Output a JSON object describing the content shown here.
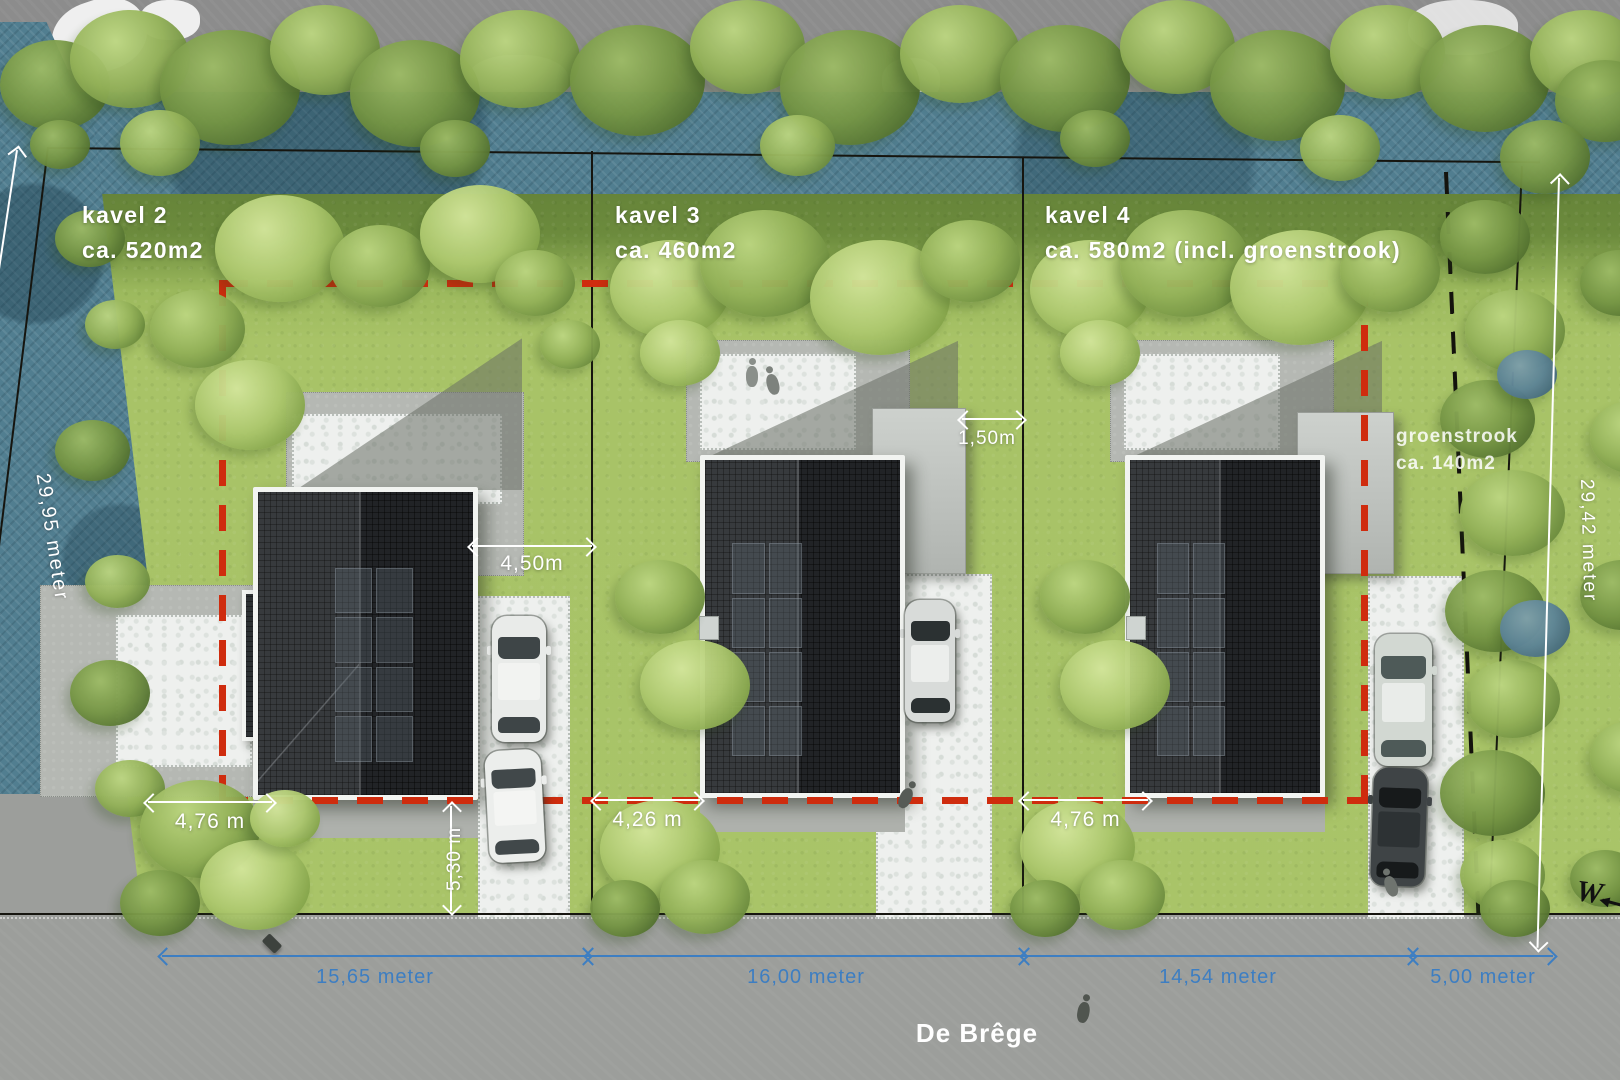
{
  "plots": [
    {
      "label": "kavel 2",
      "area": "ca. 520m2"
    },
    {
      "label": "kavel 3",
      "area": "ca. 460m2"
    },
    {
      "label": "kavel 4",
      "area": "ca. 580m2 (incl. groenstrook)"
    }
  ],
  "groenstrook": {
    "line1": "groenstrook",
    "line2": "ca. 140m2"
  },
  "boundary_dimensions": {
    "left": "29,95 meter",
    "right": "29,42 meter"
  },
  "detail_dimensions": {
    "kavel2_garage_offset": "4,50m",
    "kavel3_carport_gap": "1,50m",
    "kavel2_side_setback": "4,76 m",
    "kavel3_side_setback": "4,26 m",
    "kavel4_side_setback": "4,76 m",
    "kavel2_front_setback": "5,30 m"
  },
  "street_dimensions": [
    {
      "label": "15,65 meter"
    },
    {
      "label": "16,00 meter"
    },
    {
      "label": "14,54 meter"
    },
    {
      "label": "5,00 meter"
    }
  ],
  "street": {
    "name": "De Brêge"
  },
  "compass": {
    "west": "W"
  },
  "colors": {
    "dimension_blue": "#3d7ec2",
    "building_zone_red": "#cf2c0e",
    "dimension_white": "#ffffff",
    "water": "#517e90",
    "grass": "#a9c468"
  }
}
